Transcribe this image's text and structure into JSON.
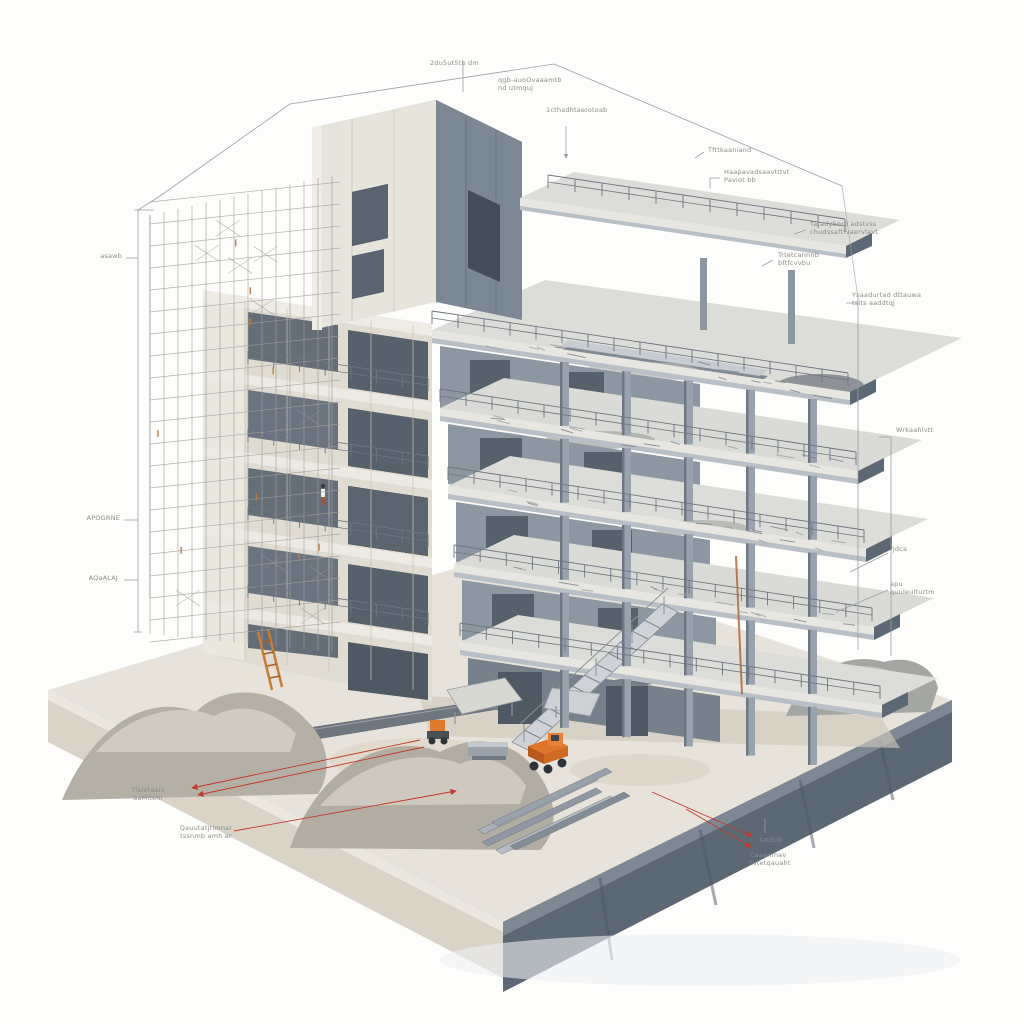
{
  "figure": {
    "description": "Isometric architectural illustration of a multi-storey reinforced-concrete building under construction on a thick concrete base slab, with scaffolding on the left, stepped open floor decks with columns and guard rails on the right, a concrete core tower on top, gravel piles, steel beams, an orange dump truck and machines on the ground, surrounded by thin dimension lines and small annotation labels, some with red leader arrows."
  },
  "palette": {
    "background": "#fdfdfc",
    "concrete_light": "#e7e3da",
    "concrete_warm": "#ddd7cb",
    "slab_face_dark": "#5c6874",
    "column_grey": "#99a3ad",
    "scaffold_grey": "#a3a099",
    "accent_orange": "#e0752a",
    "rust_orange": "#bd7a3e",
    "leader_red": "#c0392b",
    "dimension_grey": "#9b9fa2",
    "label_text": "#8b8b86"
  },
  "annotations": {
    "t1": {
      "line1": "2du5ut5tb dm",
      "line2": ""
    },
    "t2": {
      "line1": "qgb-auoOvaaamtb",
      "line2": "nd utmquj"
    },
    "t3": {
      "line1": "1cthadhtaerotoab",
      "line2": ""
    },
    "r1": {
      "line1": "Tfttkaaniand",
      "line2": ""
    },
    "r2": {
      "line1": "Haapavadsaavtttvt",
      "line2": "Paviot bb"
    },
    "r3": {
      "line1": "Tatadybord adstvss",
      "line2": "chudssaftfvaervlavt"
    },
    "r4": {
      "line1": "Trtetcannnb",
      "line2": "bftfcvvbu"
    },
    "r5": {
      "line1": "Ysaadurtad dttauwa",
      "line2": "tsits aaddtqj"
    },
    "r6": {
      "line1": "Wrkaahlvtt",
      "line2": ""
    },
    "r7": {
      "line1": "rjdca",
      "line2": ""
    },
    "r8": {
      "line1": "apu",
      "line2": "quuleulturtm"
    },
    "l1": {
      "line1": "asawb",
      "line2": ""
    },
    "l2": {
      "line1": "APOGRNE",
      "line2": ""
    },
    "l3": {
      "line1": "AQaALAJ",
      "line2": ""
    },
    "bl1": {
      "line1": "Tlaietaaio",
      "line2": "aaMitem"
    },
    "bl2": {
      "line1": "Qauutatjtlmnar",
      "line2": "tssnmb amh ar"
    },
    "br1": {
      "line1": "tatddb",
      "line2": ""
    },
    "br2": {
      "line1": "Caaemnav",
      "line2": "tvtetqauaht"
    }
  }
}
